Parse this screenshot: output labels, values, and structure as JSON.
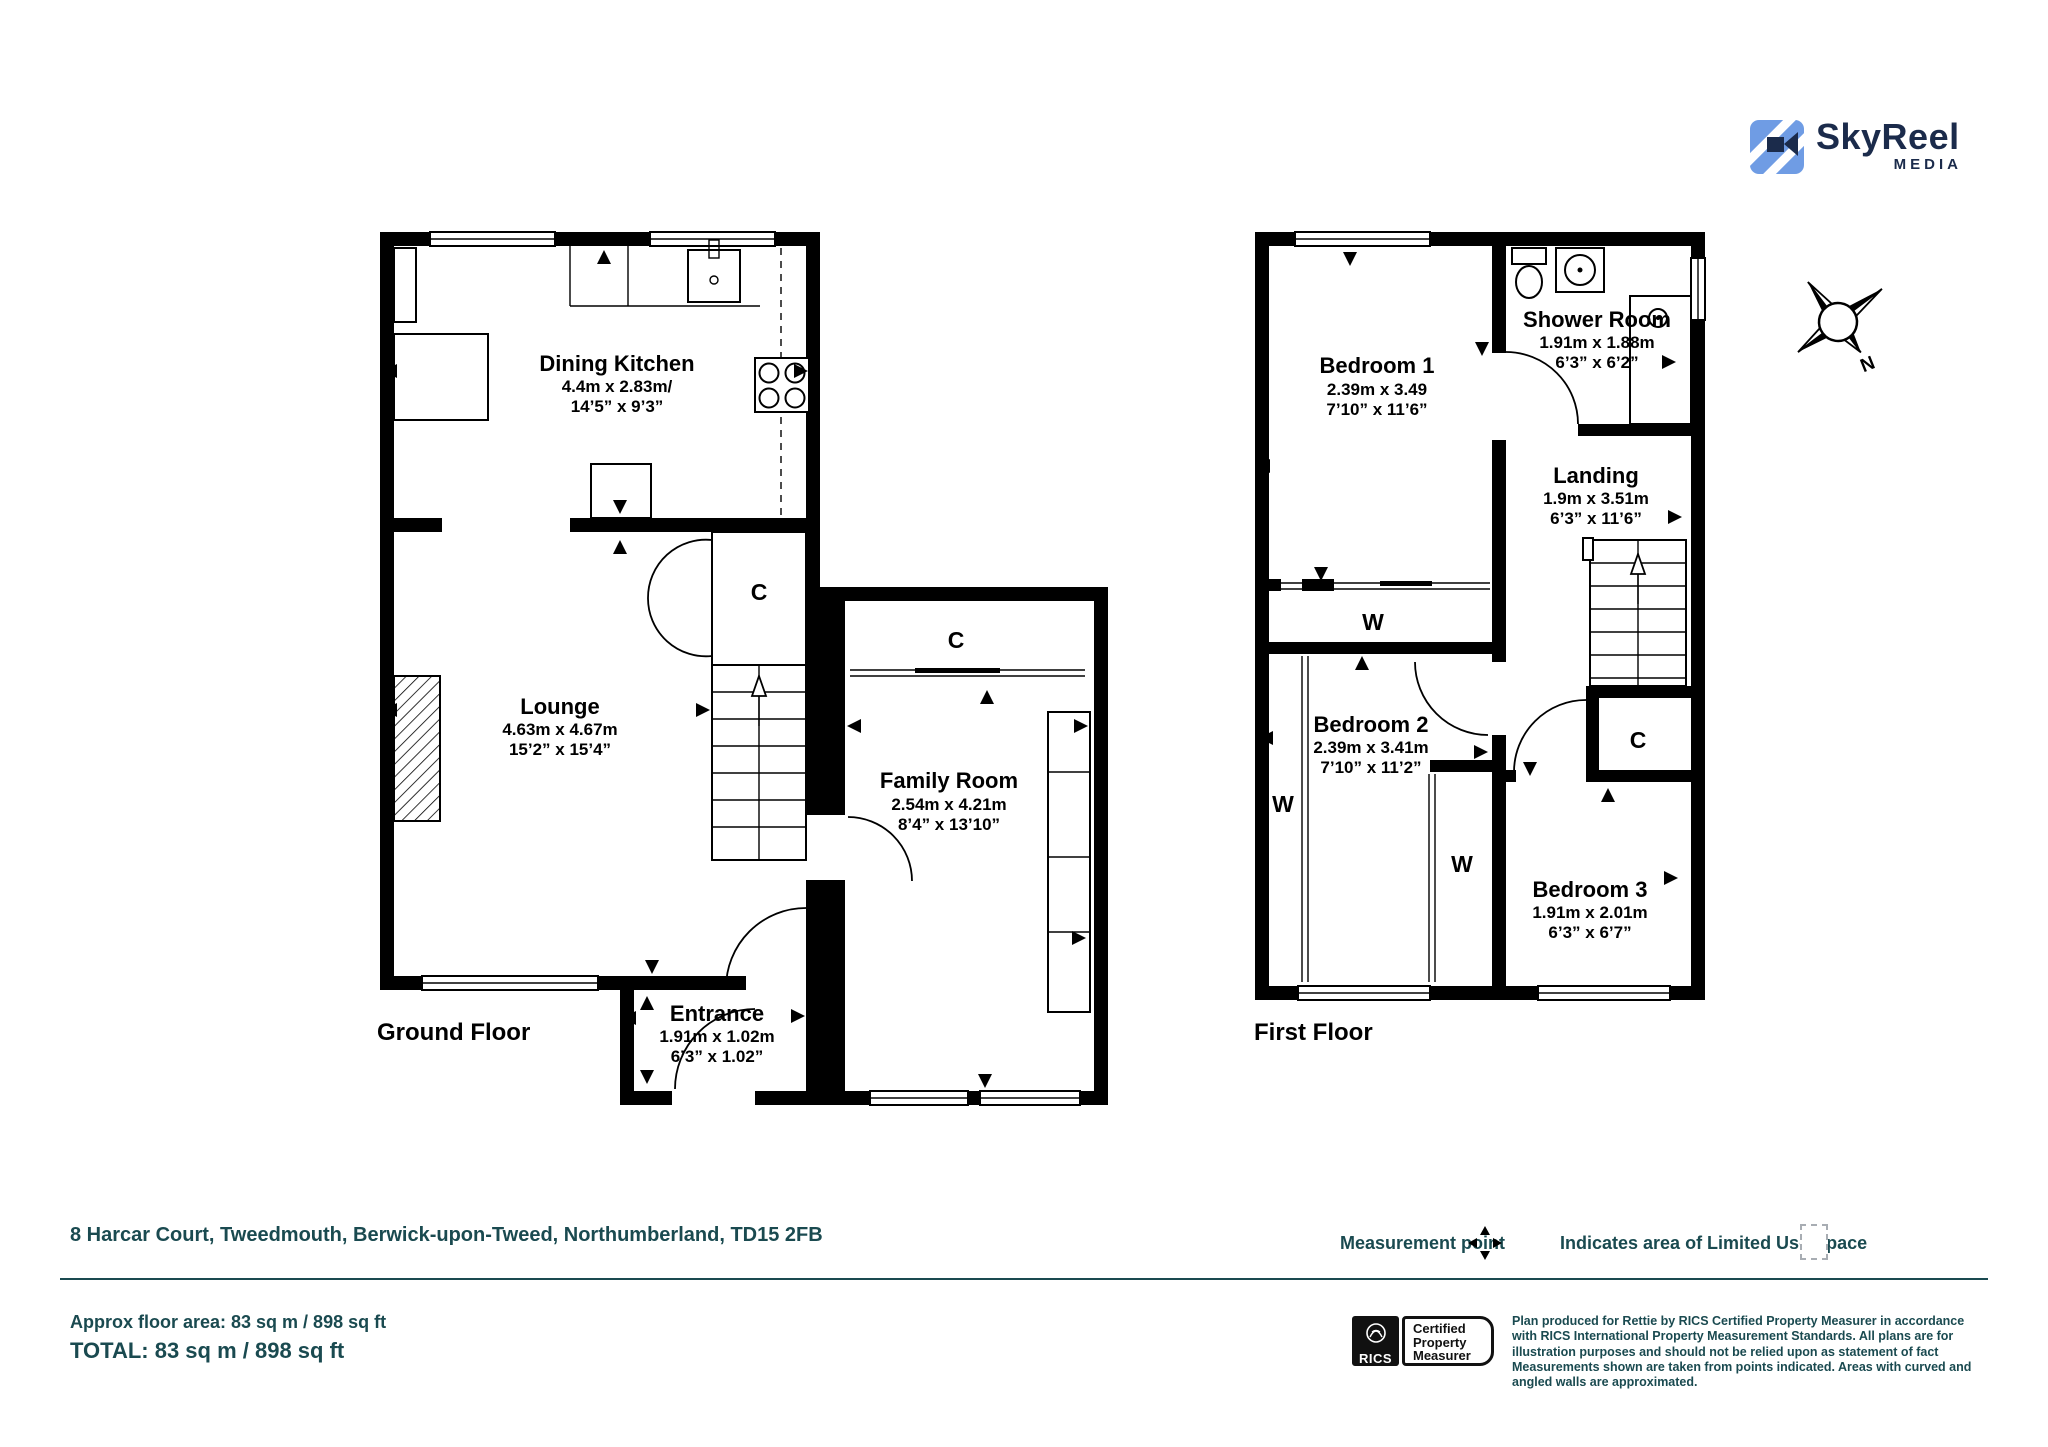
{
  "logo": {
    "name": "SkyReel",
    "tagline": "MEDIA"
  },
  "colors": {
    "teal": "#1a4a50",
    "logo_blue": "#6f9ce4",
    "logo_navy": "#1b2b4b",
    "wall": "#000000"
  },
  "plans": {
    "ground": {
      "label": "Ground Floor",
      "rooms": [
        {
          "name": "Dining Kitchen",
          "metric": "4.4m x 2.83m/",
          "imperial": "14’5” x 9’3”"
        },
        {
          "name": "Lounge",
          "metric": "4.63m x 4.67m",
          "imperial": "15’2” x 15’4”"
        },
        {
          "name": "Family Room",
          "metric": "2.54m x 4.21m",
          "imperial": "8’4” x 13’10”"
        },
        {
          "name": "Entrance",
          "metric": "1.91m x 1.02m",
          "imperial": "6’3” x 1.02”"
        }
      ],
      "closet_labels": {
        "stair_closet": "C",
        "family_cupboard": "C"
      }
    },
    "first": {
      "label": "First Floor",
      "rooms": [
        {
          "name": "Bedroom 1",
          "metric": "2.39m x 3.49",
          "imperial": "7’10” x 11’6”"
        },
        {
          "name": "Shower Room",
          "metric": "1.91m x 1.88m",
          "imperial": "6’3” x 6’2”"
        },
        {
          "name": "Landing",
          "metric": "1.9m x 3.51m",
          "imperial": "6’3” x 11’6”"
        },
        {
          "name": "Bedroom 2",
          "metric": "2.39m x 3.41m",
          "imperial": "7’10” x 11’2”"
        },
        {
          "name": "Bedroom 3",
          "metric": "1.91m x 2.01m",
          "imperial": "6’3” x 6’7”"
        }
      ],
      "wardrobe_labels": {
        "bedroom1_wardrobe": "W",
        "bedroom2_left_wardrobe": "W",
        "bedroom2_closet": "W"
      },
      "closet_label": "C"
    }
  },
  "compass": {
    "north": "N"
  },
  "footer": {
    "address": "8 Harcar Court, Tweedmouth, Berwick-upon-Tweed, Northumberland, TD15 2FB",
    "approx_area": "Approx floor area: 83 sq m / 898 sq ft",
    "total": "TOTAL: 83 sq m / 898 sq ft",
    "measurement_point_label": "Measurement point",
    "limited_use_label": "Indicates area of  Limited Use Space",
    "rics": {
      "brand": "RICS",
      "badge_line1": "Certified",
      "badge_line2": "Property",
      "badge_line3": "Measurer"
    },
    "disclaimer": "Plan produced for Rettie by RICS Certified Property Measurer in accordance with RICS International Property  Measurement Standards.  All plans are for illustration purposes and should not be relied upon as statement of fact Measurements shown are taken from points indicated. Areas with curved and angled walls are approximated."
  }
}
